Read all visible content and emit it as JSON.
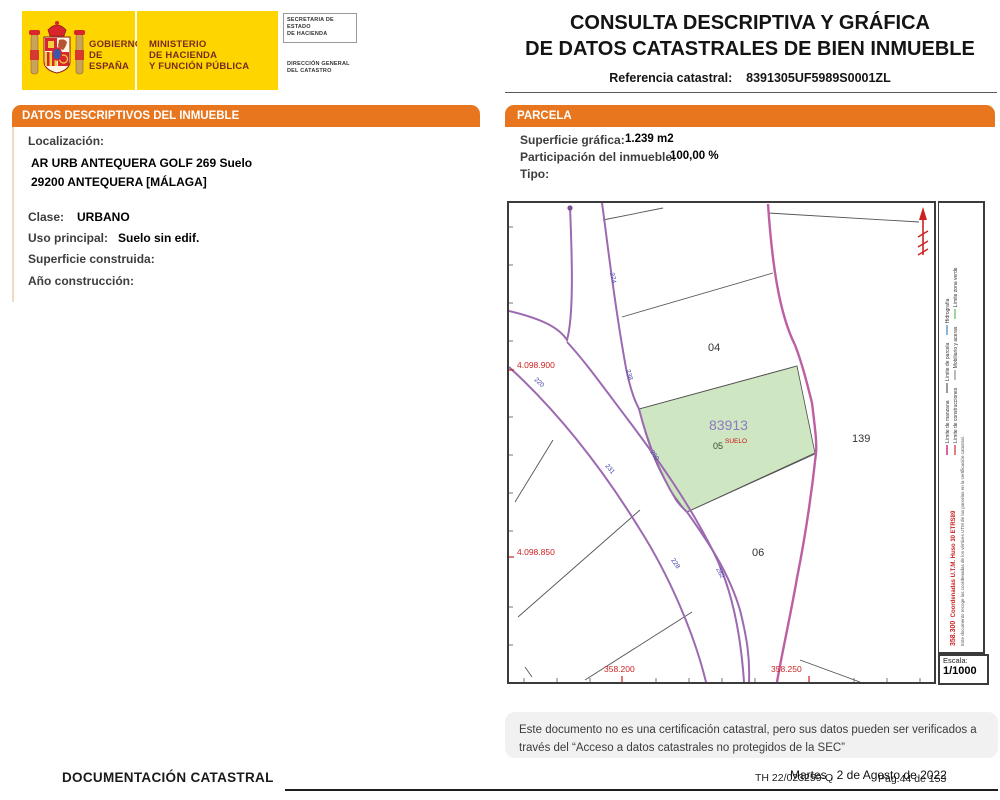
{
  "colors": {
    "accent_orange": "#E8761E",
    "flag_yellow": "#FFD500",
    "parcel_green": "#CFE6C2",
    "road_purple": "#9B6AB0",
    "boundary_magenta": "#BD5FA3",
    "coord_red": "#CC2222"
  },
  "header": {
    "g1": "GOBIERNO",
    "g2": "DE ESPAÑA",
    "m1": "MINISTERIO",
    "m2": "DE HACIENDA",
    "m3": "Y FUNCIÓN PÚBLICA",
    "s1": "SECRETARIA DE ESTADO",
    "s2": "DE HACIENDA",
    "d1": "DIRECCIÓN GENERAL",
    "d2": "DEL CATASTRO",
    "title1": "CONSULTA DESCRIPTIVA Y GRÁFICA",
    "title2": "DE DATOS CATASTRALES DE BIEN INMUEBLE",
    "ref_label": "Referencia catastral:",
    "ref_value": "8391305UF5989S0001ZL"
  },
  "left_panel": {
    "header": "DATOS DESCRIPTIVOS DEL INMUEBLE",
    "loc_label": "Localización:",
    "addr1": "AR URB ANTEQUERA GOLF 269 Suelo",
    "addr2": "29200 ANTEQUERA [MÁLAGA]",
    "clase_label": "Clase:",
    "clase_value": "URBANO",
    "uso_label": "Uso principal:",
    "uso_value": "Suelo sin edif.",
    "sup_label": "Superficie construida:",
    "anio_label": "Año construcción:"
  },
  "right_panel": {
    "header": "PARCELA",
    "sup_label": "Superficie gráfica:",
    "sup_value": "1.239 m2",
    "part_label": "Participación del inmueble:",
    "part_value": "100,00 %",
    "tipo_label": "Tipo:"
  },
  "map": {
    "parcel_id": "83913",
    "parcel_sub": "SUELO",
    "parcel_floor": "05",
    "p04": "04",
    "p139": "139",
    "p06": "06",
    "r274": "274",
    "r238": "238",
    "r220": "220",
    "r231": "231",
    "r260": "260",
    "r228": "228",
    "r262": "262",
    "y1": "4.098.900",
    "y2": "4.098.850",
    "x1": "358.200",
    "x2": "358.250",
    "x3": "358.300",
    "legend1": "Límite de manzana",
    "legend2": "Límite de parcela",
    "legend3": "Hidrografía",
    "legend4": "Límite de construcciones",
    "legend5": "Mobiliario y aceras",
    "legend6": "Límite zona verde",
    "utm": "Coordenadas U.T.M. Huso 30 ETRS89",
    "side_note": "Este documento recoge las coordenadas de los vértices UTM de las parcelas en la certificación catastral.",
    "escala_label": "Escala:",
    "escala_value": "1/1000"
  },
  "footer": {
    "note1": "Este documento no es una certificación catastral, pero sus datos pueden ser verificados a",
    "note2": "través del “Acceso a datos catastrales no protegidos de la SEC”",
    "th_ref": "TH 22/023259-Q",
    "page": "Pág.44 de 153",
    "date": "Martes , 2 de Agosto de 2022",
    "doc_title": "DOCUMENTACIÓN CATASTRAL"
  }
}
